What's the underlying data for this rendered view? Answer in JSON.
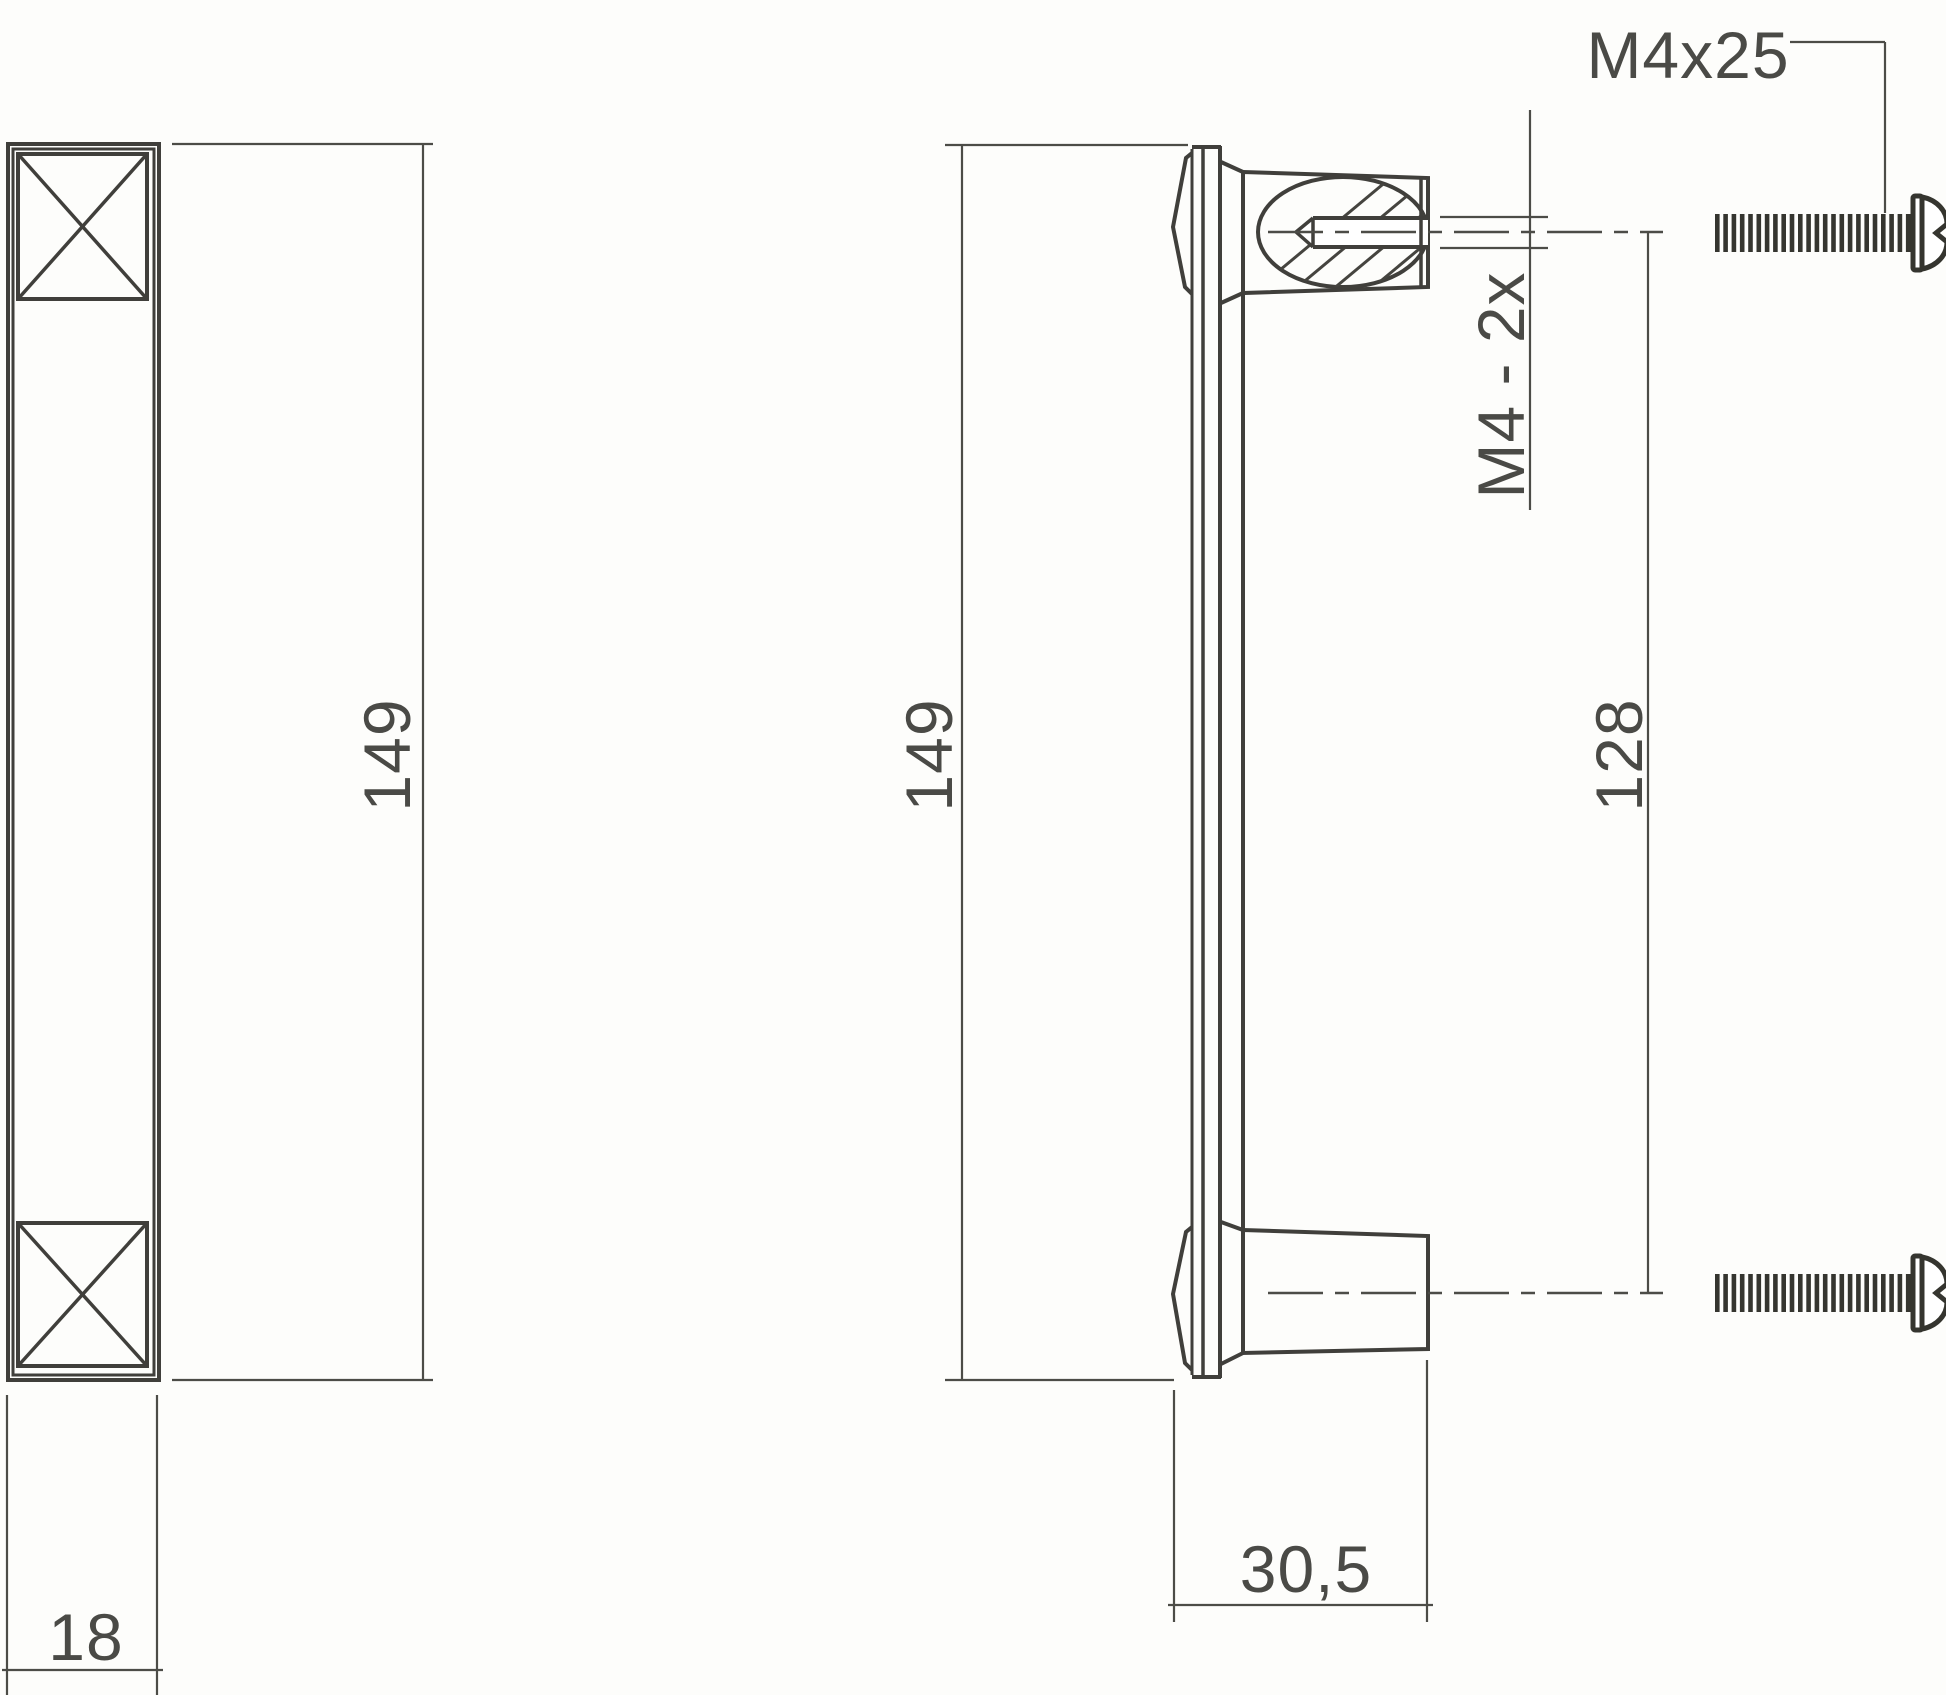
{
  "drawing": {
    "type": "technical-dimension-drawing",
    "subject": "furniture-handle-with-mounting-screws",
    "views": {
      "front": {
        "height_label": "149",
        "width_label": "18"
      },
      "side": {
        "height_label": "149",
        "hole_spacing_label": "128",
        "depth_label": "30,5",
        "thread_label": "M4 - 2x"
      },
      "hardware": {
        "screw_label": "M4x25",
        "screw_count": 2
      }
    },
    "colors": {
      "object_line": "#403f3b",
      "dimension_line": "#4c4c47",
      "text": "#4a4a46",
      "screw": "#35352f",
      "background": "#fdfdfb"
    }
  }
}
